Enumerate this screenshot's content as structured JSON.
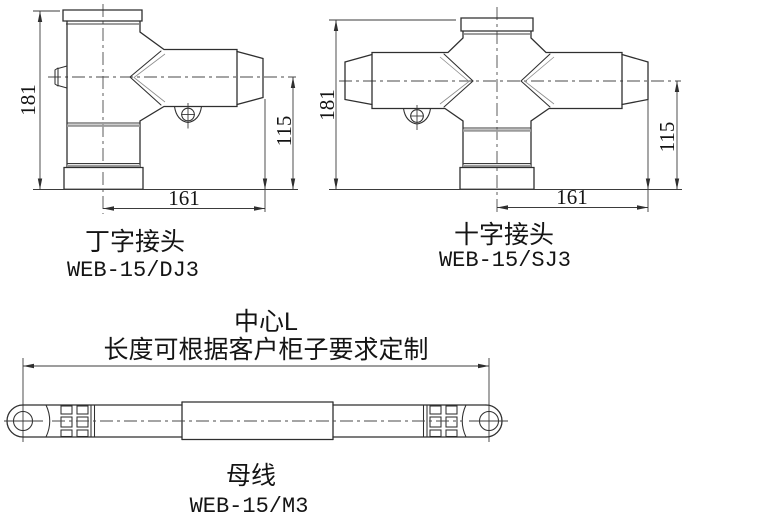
{
  "figures": {
    "t_joint": {
      "label": "丁字接头",
      "model": "WEB-15/DJ3",
      "dim_height": "181",
      "dim_branch_height": "115",
      "dim_width": "161"
    },
    "cross_joint": {
      "label": "十字接头",
      "model": "WEB-15/SJ3",
      "dim_height": "181",
      "dim_branch_height": "115",
      "dim_width": "161"
    },
    "busbar": {
      "label": "母线",
      "model": "WEB-15/M3",
      "note_center": "中心L",
      "note_length": "长度可根据客户柜子要求定制"
    }
  },
  "colors": {
    "background": "#ffffff",
    "line": "#2f2f2f"
  }
}
